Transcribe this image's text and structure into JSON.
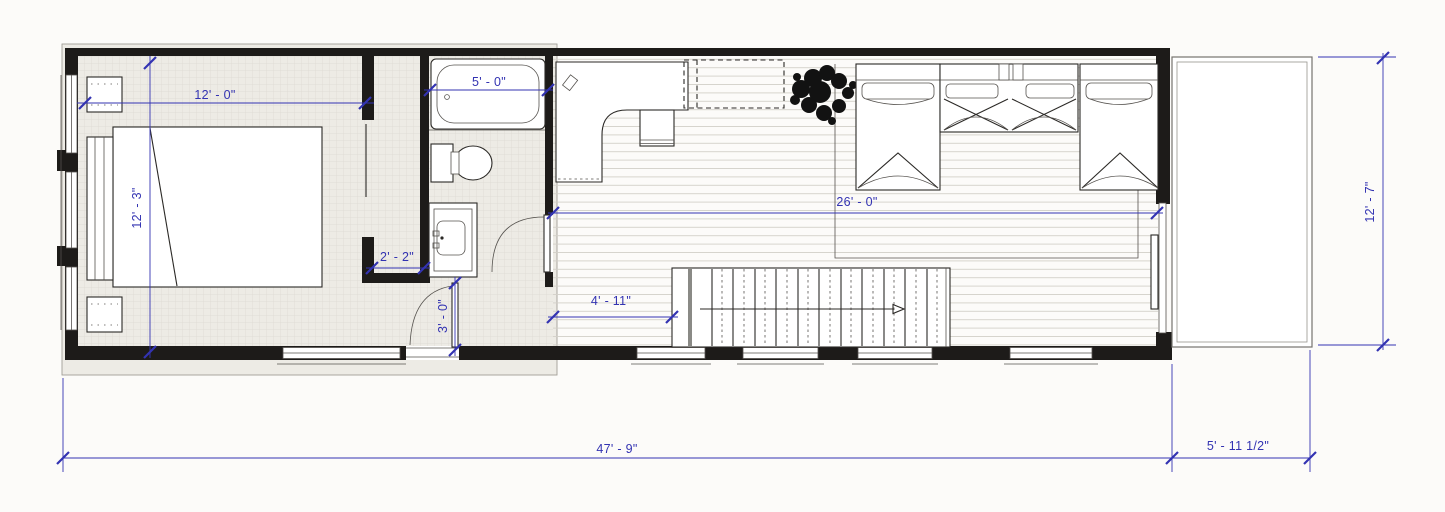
{
  "drawing_type": "architectural floor plan",
  "colors": {
    "dimension_blue": "#3333b2",
    "wall_black": "#1d1b19",
    "selection_gray": "#edebe5",
    "floor_line_gray": "#d2cfc8",
    "background": "#fcfbf9",
    "plant_black": "#121212"
  },
  "dimensions": {
    "bedroom_width": {
      "label": "12' - 0\""
    },
    "bedroom_depth": {
      "label": "12' - 3\""
    },
    "tub_length": {
      "label": "5' - 0\""
    },
    "closet_width": {
      "label": "2' - 2\""
    },
    "entry_door_width": {
      "label": "3' - 0\""
    },
    "stair_clearance": {
      "label": "4' - 11\""
    },
    "living_length": {
      "label": "26' - 0\""
    },
    "overall_length": {
      "label": "47' - 9\""
    },
    "deck_width": {
      "label": "5' - 11 1/2\""
    },
    "deck_depth": {
      "label": "12' - 7\""
    }
  },
  "fixtures": [
    "master-bed",
    "nightstand",
    "bathtub",
    "toilet",
    "vanity-sink",
    "closet",
    "entry-door",
    "bathroom-door",
    "built-in-desk",
    "desk-chair",
    "upper-cabinets",
    "potted-plant",
    "area-rug",
    "twin-bed-left",
    "bunk-bed-middle",
    "twin-bed-right",
    "staircase",
    "stair-direction-arrow",
    "sliding-glass-door",
    "deck",
    "window"
  ]
}
